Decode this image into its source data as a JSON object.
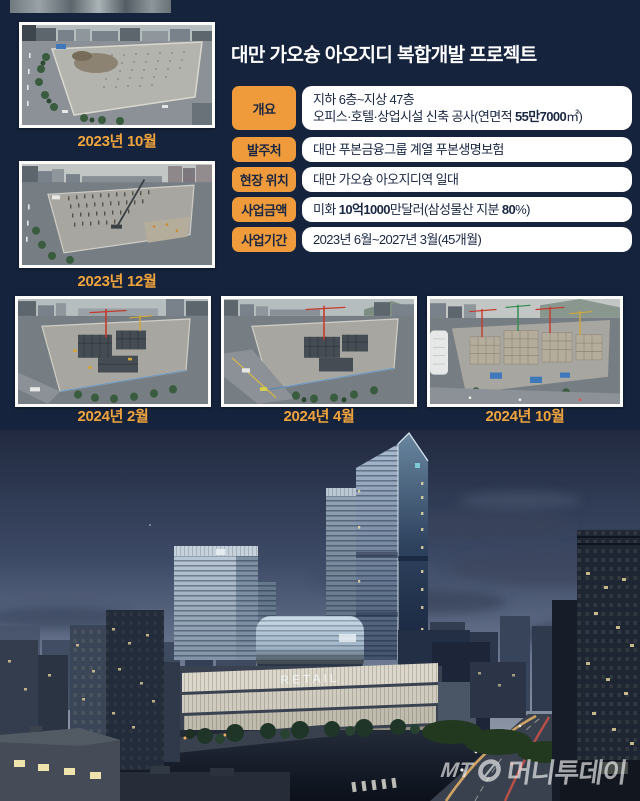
{
  "colors": {
    "background": "#15233C",
    "accent_orange": "#F09B3B",
    "caption_orange": "#F2A43C",
    "box_white": "#FFFFFF",
    "text_navy": "#1A2742"
  },
  "header": {
    "title": "대만 가오슝 아오지디 복합개발 프로젝트"
  },
  "table": {
    "rows": [
      {
        "label": "개요",
        "lines": [
          [
            {
              "t": "지하 6층~지상 47층"
            }
          ],
          [
            {
              "t": "오피스·호텔·상업시설 신축 공사(연면적 "
            },
            {
              "t": "55만7000",
              "b": true
            },
            {
              "t": "㎡)"
            }
          ]
        ]
      },
      {
        "label": "발주처",
        "lines": [
          [
            {
              "t": "대만 푸본금융그룹 계열 푸본생명보험"
            }
          ]
        ]
      },
      {
        "label": "현장 위치",
        "lines": [
          [
            {
              "t": "대만 가오슝 아오지디역 일대"
            }
          ]
        ]
      },
      {
        "label": "사업금액",
        "lines": [
          [
            {
              "t": "미화 "
            },
            {
              "t": "10억1000",
              "b": true
            },
            {
              "t": "만달러(삼성물산 지분 "
            },
            {
              "t": "80",
              "b": true
            },
            {
              "t": "%)"
            }
          ]
        ]
      },
      {
        "label": "사업기간",
        "lines": [
          [
            {
              "t": "2023년 6월~2027년 3월(45개월)"
            }
          ]
        ]
      }
    ]
  },
  "photos": [
    {
      "caption": "2023년 10월"
    },
    {
      "caption": "2023년 12월"
    },
    {
      "caption": "2024년 2월"
    },
    {
      "caption": "2024년 4월"
    },
    {
      "caption": "2024년 10월"
    }
  ],
  "render": {
    "retail_sign": "RETAIL",
    "watermark_prefix": "MT",
    "watermark_name": "머니투데이"
  }
}
